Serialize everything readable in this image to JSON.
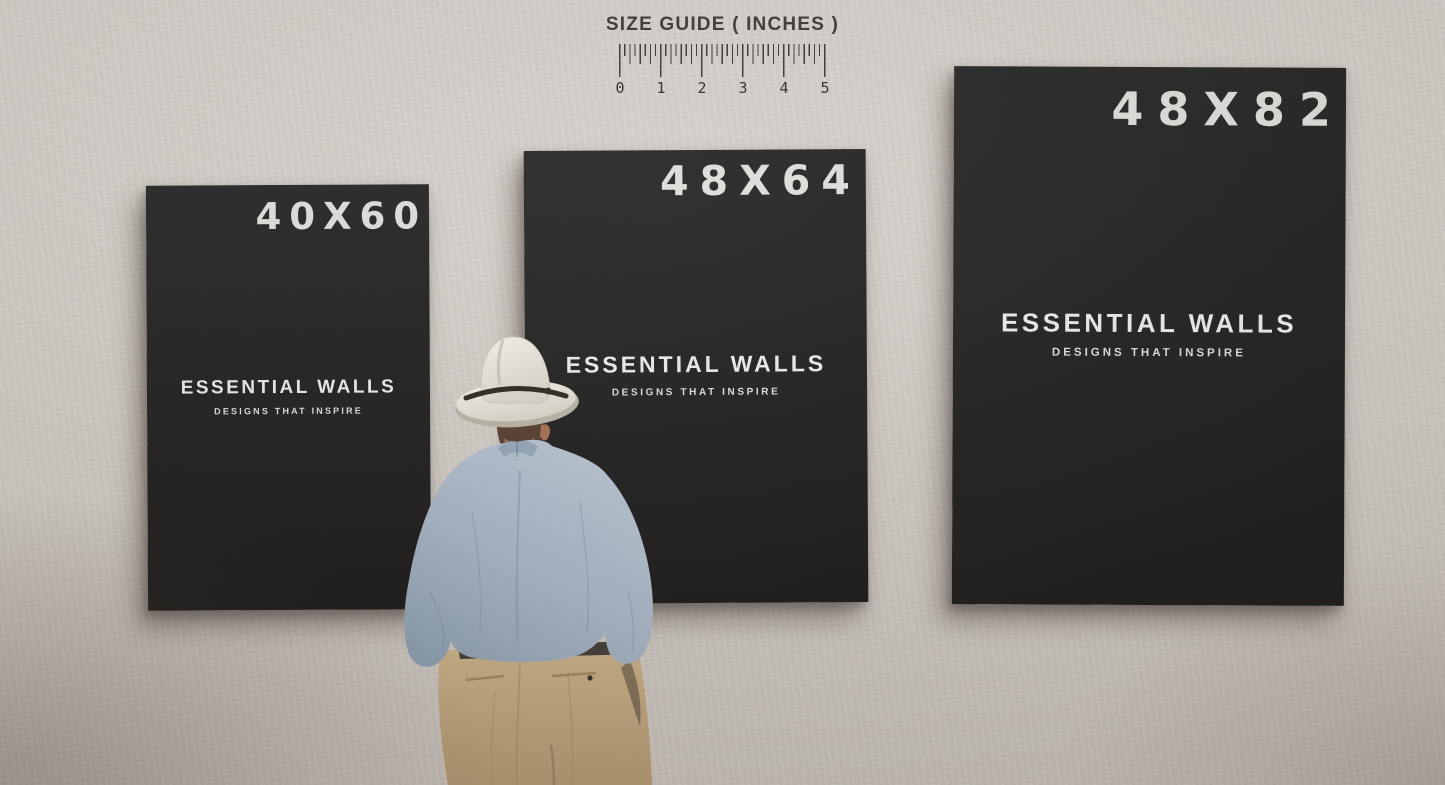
{
  "size_guide": {
    "title": "SIZE GUIDE ( INCHES )",
    "unit_ticks": [
      "0",
      "1",
      "2",
      "3",
      "4",
      "5"
    ]
  },
  "posters": [
    {
      "size_label": "40X60",
      "brand": "ESSENTIAL WALLS",
      "tagline": "DESIGNS THAT INSPIRE"
    },
    {
      "size_label": "48X64",
      "brand": "ESSENTIAL WALLS",
      "tagline": "DESIGNS THAT INSPIRE"
    },
    {
      "size_label": "48X82",
      "brand": "ESSENTIAL WALLS",
      "tagline": "DESIGNS THAT INSPIRE"
    }
  ],
  "colors": {
    "wall": "#d7d2cc",
    "poster_background": "#161616",
    "poster_text": "#ece9e6",
    "ruler_ink": "#32302e",
    "hat": "#e8e4da",
    "shirt": "#a3b2c3",
    "trousers": "#c2a77f"
  }
}
